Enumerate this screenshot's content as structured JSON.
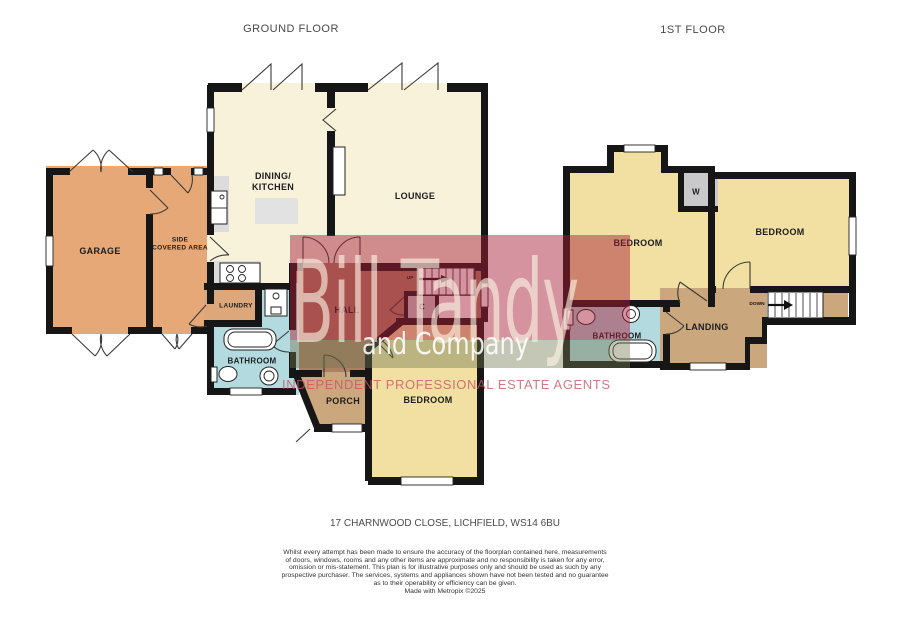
{
  "palette": {
    "wall": "#161616",
    "cream": "#F8F2DA",
    "orange": "#E5A876",
    "yellow": "#F1E0A2",
    "blue": "#B2DADF",
    "tan": "#CBA77D",
    "laundry_tan": "#DCA77B",
    "hall_brown": "#AB8065",
    "closet_gray": "#C9C9CB",
    "counter_gray": "#DCDCDC",
    "island_gray": "#E2E2E2",
    "fixture_white": "#FFFFFF",
    "door_line": "#3a3a3a",
    "red_band": "rgba(165,30,55,0.48)",
    "olive_band": "rgba(115,118,80,0.42)",
    "brand_text": "rgba(252,243,228,0.62)",
    "sub_text": "rgba(255,255,255,0.88)",
    "tagline_text": "rgba(200,86,100,0.8)",
    "label_dark": "#1d1d1d",
    "heading_gray": "#4a4a4a",
    "fine_print": "#333333"
  },
  "headers": {
    "ground": "GROUND FLOOR",
    "first": "1ST FLOOR"
  },
  "ground_floor": {
    "labels": {
      "garage": "GARAGE",
      "side_line1": "SIDE",
      "side_line2": "COVERED AREA",
      "dining_line1": "DINING/",
      "dining_line2": "KITCHEN",
      "lounge": "LOUNGE",
      "laundry": "LAUNDRY",
      "hall": "HALL",
      "closet": "C",
      "up": "UP",
      "bathroom": "BATHROOM",
      "porch": "PORCH",
      "bedroom": "BEDROOM"
    }
  },
  "first_floor": {
    "labels": {
      "bedroom_left": "BEDROOM",
      "bedroom_right": "BEDROOM",
      "wardrobe": "W",
      "bathroom": "BATHROOM",
      "landing": "LANDING",
      "down": "DOWN"
    }
  },
  "watermark": {
    "brand": "Bill Tandy",
    "sub": "and Company",
    "tagline": "INDEPENDENT PROFESSIONAL ESTATE AGENTS"
  },
  "address": "17 CHARNWOOD CLOSE, LICHFIELD, WS14 6BU",
  "disclaimer": {
    "lines": [
      "Whilst every attempt has been made to ensure the accuracy of the floorplan contained here, measurements",
      "of doors, windows, rooms and any other items are approximate and no responsibility is taken for any error,",
      "omission or mis-statement. This plan is for illustrative purposes only and should be used as such by any",
      "prospective purchaser. The services, systems and appliances shown have not been tested and no guarantee",
      "as to their operability or efficiency can be given.",
      "Made with Metropix ©2025"
    ]
  }
}
